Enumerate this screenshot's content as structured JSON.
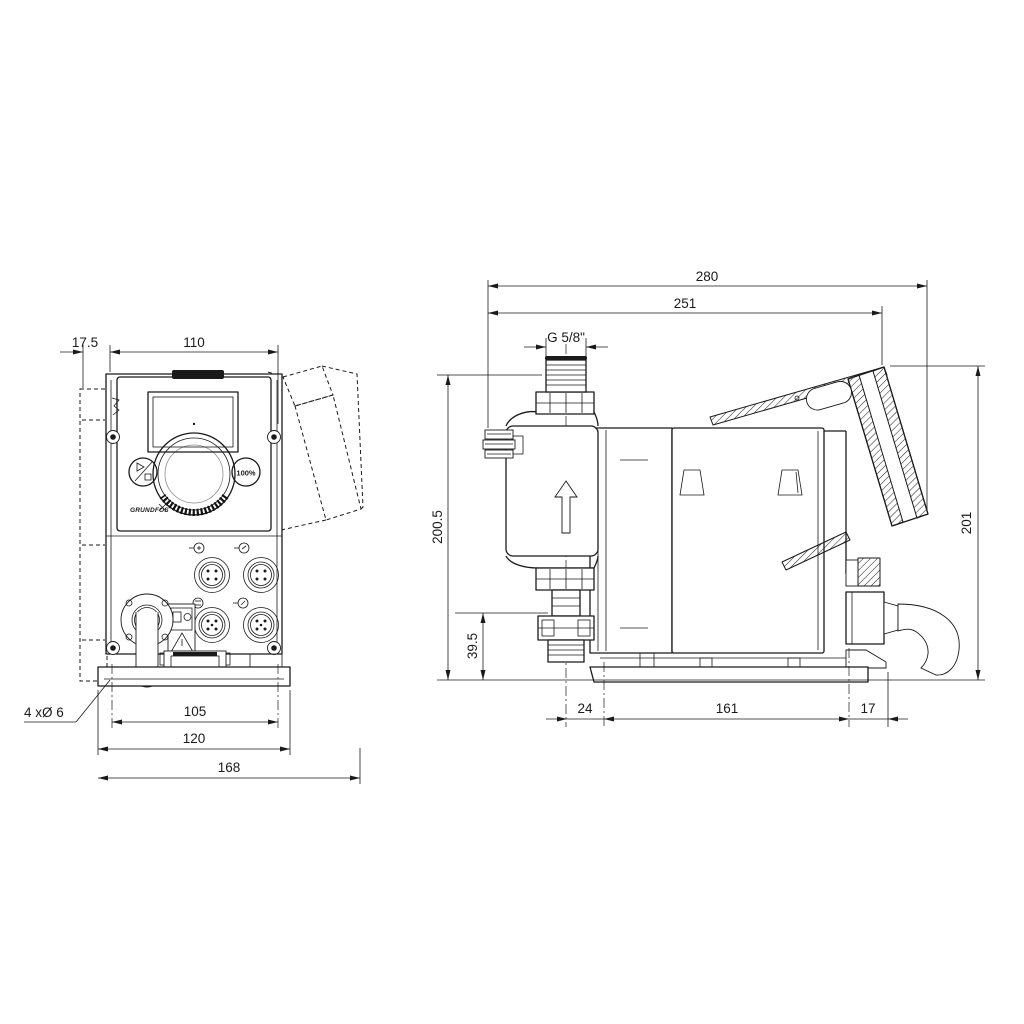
{
  "page": {
    "background": "#ffffff",
    "line_color": "#1a1a1a"
  },
  "front_view": {
    "dims": {
      "plate_offset": "17.5",
      "panel_width": "110",
      "hole_pitch": "105",
      "bracket_width": "120",
      "overall_width": "168",
      "mounting_holes": "4 xØ 6"
    },
    "controls": {
      "logo": "GRUNDFOS",
      "percent_key": "100%"
    }
  },
  "side_view": {
    "dims": {
      "overall_length": "280",
      "length_to_hinge": "251",
      "thread": "G 5/8\"",
      "height": "200.5",
      "suction_height": "39.5",
      "cover_height": "201",
      "front_offset": "24",
      "hole_pitch": "161",
      "rear_offset": "17"
    }
  }
}
